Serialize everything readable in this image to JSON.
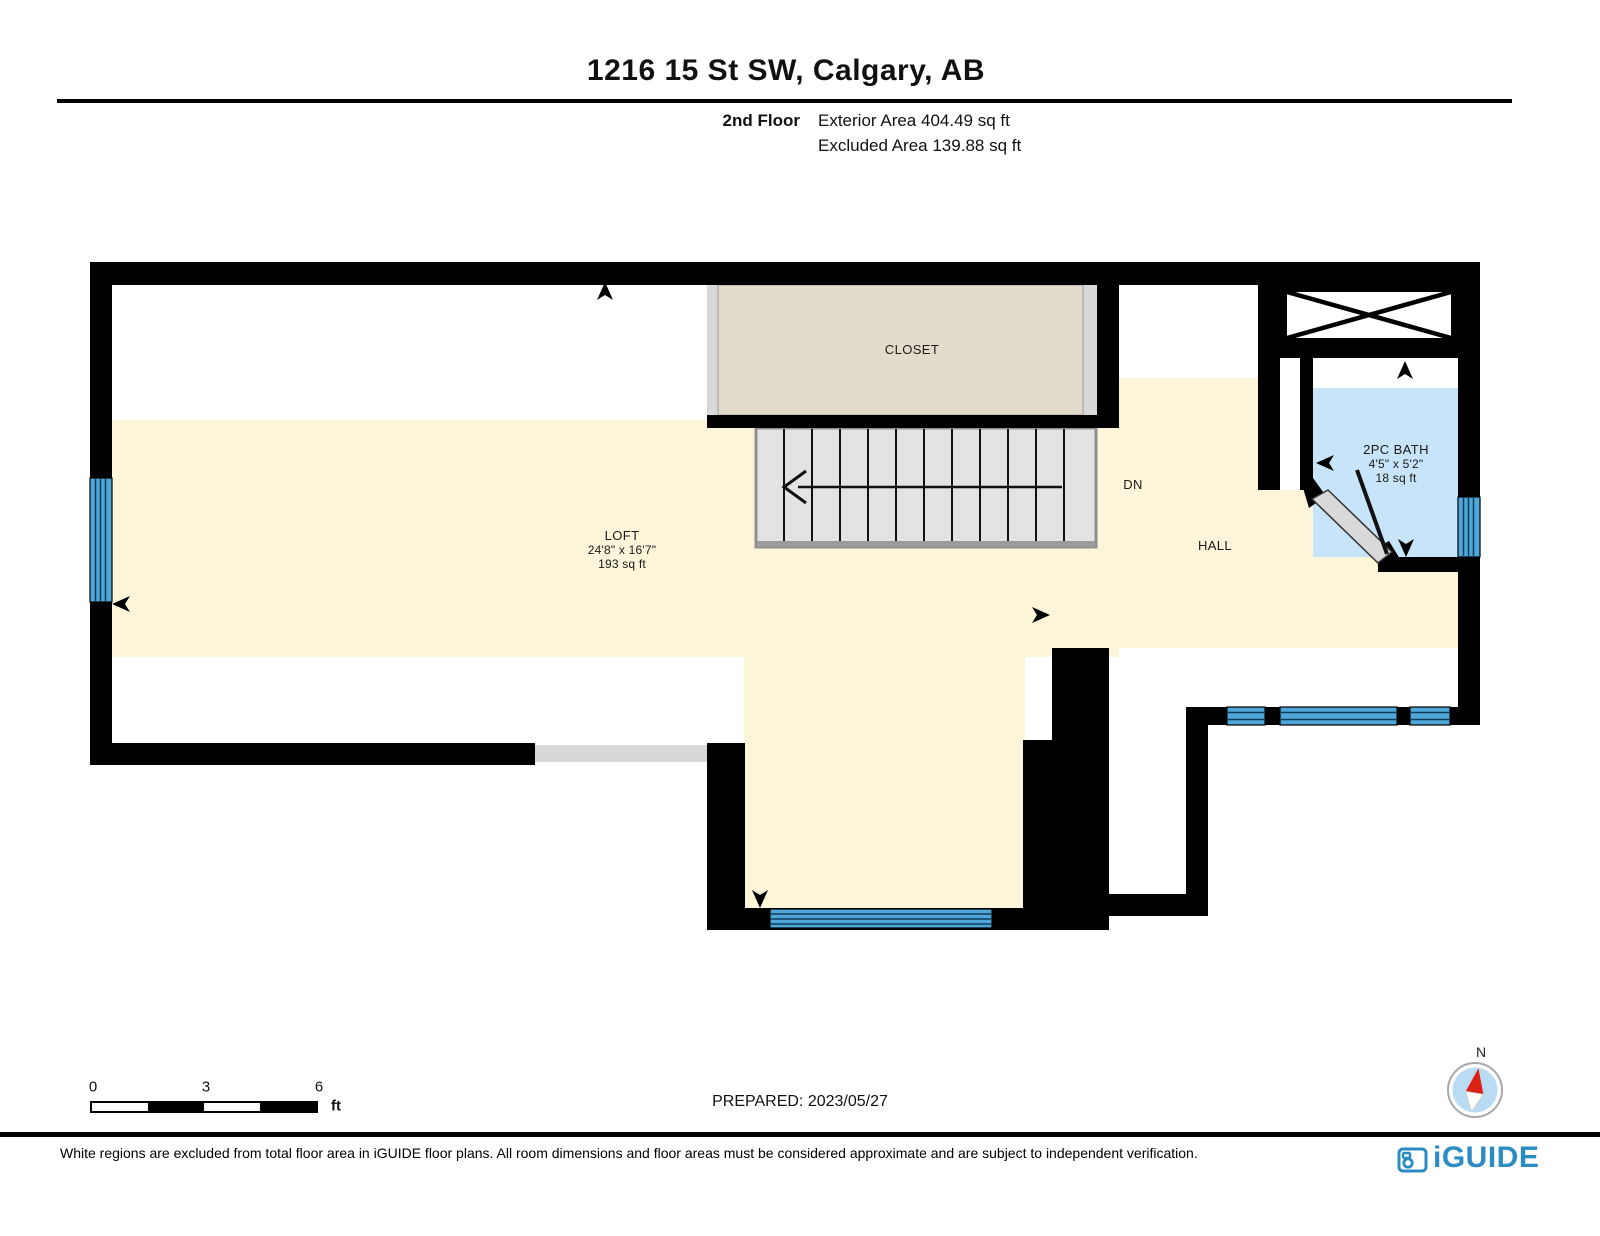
{
  "header": {
    "title": "1216 15 St SW, Calgary, AB",
    "floor_label": "2nd Floor",
    "exterior_area": "Exterior Area 404.49 sq ft",
    "excluded_area": "Excluded Area 139.88 sq ft"
  },
  "rooms": {
    "closet": {
      "label": "CLOSET"
    },
    "loft": {
      "label": "LOFT",
      "dimensions": "24'8\" x 16'7\"",
      "area": "193 sq ft"
    },
    "hall": {
      "label": "HALL"
    },
    "bath": {
      "label": "2PC BATH",
      "dimensions": "4'5\" x 5'2\"",
      "area": "18 sq ft"
    },
    "stair": {
      "label": "DN"
    }
  },
  "scale_bar": {
    "ticks": [
      "0",
      "3",
      "6"
    ],
    "unit": "ft"
  },
  "prepared_label": "PREPARED: 2023/05/27",
  "compass": {
    "north_label": "N"
  },
  "footer": {
    "disclaimer": "White regions are excluded from total floor area in iGUIDE floor plans. All room dimensions and floor areas must be considered approximate and are subject to independent verification.",
    "brand": "iGUIDE"
  },
  "colors": {
    "floor_cream": "#fcf5da",
    "closet_beige": "#e4dccb",
    "bath_blue": "#c8e4f8",
    "window_blue": "#4fa6d9",
    "stair_gray": "#e3e3e3",
    "door_gray": "#d8d8d8",
    "wall_black": "#000000",
    "brand_blue": "#2b8cc4",
    "compass_blue": "#b9dcf4",
    "compass_red": "#dd2015"
  }
}
